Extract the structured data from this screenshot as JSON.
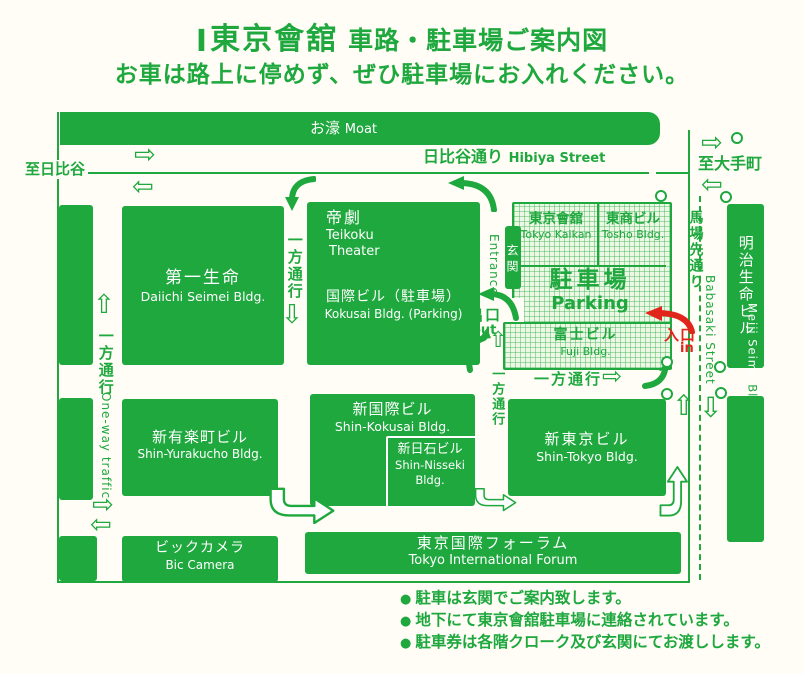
{
  "colors": {
    "green": "#1ea83e",
    "red": "#e1251b",
    "paper": "#fffdf6",
    "hatch_fill": "#ecf7e4"
  },
  "glyphs": {
    "logo": "Ⅰ",
    "bullet": "●",
    "arrow_right": "⇨",
    "arrow_left": "⇦",
    "arrow_up": "⇧",
    "arrow_down": "⇩"
  },
  "title": {
    "main": "東京會舘",
    "suffix": "車路・駐車場ご案内図",
    "subtitle": "お車は路上に停めず、ぜひ駐車場にお入れください。"
  },
  "map": {
    "moat_jp": "お濠",
    "moat_en": "Moat",
    "hibiya_jp": "日比谷通り",
    "hibiya_en": "Hibiya Street",
    "to_hibiya": "至日比谷",
    "to_otemachi": "至大手町",
    "babasaki_jp": "馬場先通り",
    "babasaki_en": "Babasaki Street",
    "one_way_jp": "一方通行",
    "one_way_en": "One-way traffic",
    "entrance_jp": "玄関",
    "entrance_en": "Entrance",
    "exit_jp": "出口",
    "exit_en": "out",
    "in_jp": "入口",
    "in_en": "in",
    "buildings": {
      "daiichi_jp": "第一生命",
      "daiichi_en": "Daiichi Seimei Bldg.",
      "teikoku_jp": "帝劇",
      "teikoku_en1": "Teikoku",
      "teikoku_en2": "Theater",
      "kokusai_jp": "国際ビル（駐車場）",
      "kokusai_en": "Kokusai Bldg. (Parking)",
      "kaikan_jp": "東京會舘",
      "kaikan_en": "Tokyo Kaikan",
      "tosho_jp": "東商ビル",
      "tosho_en": "Tosho Bldg.",
      "parking_jp": "駐車場",
      "parking_en": "Parking",
      "fuji_jp": "富士ビル",
      "fuji_en": "Fuji Bldg.",
      "shin_yurakucho_jp": "新有楽町ビル",
      "shin_yurakucho_en": "Shin-Yurakucho Bldg.",
      "shin_kokusai_jp": "新国際ビル",
      "shin_kokusai_en": "Shin-Kokusai Bldg.",
      "shin_nisseki_jp": "新日石ビル",
      "shin_nisseki_en1": "Shin-Nisseki",
      "shin_nisseki_en2": "Bldg.",
      "shin_tokyo_jp": "新東京ビル",
      "shin_tokyo_en": "Shin-Tokyo Bldg.",
      "bic_jp": "ビックカメラ",
      "bic_en": "Bic Camera",
      "forum_jp": "東京国際フォーラム",
      "forum_en": "Tokyo International Forum",
      "meiji_jp": "明治生命ビル",
      "meiji_en1": "Meiji Seimei",
      "meiji_en2": "Bldg."
    }
  },
  "notes": [
    "駐車は玄関でご案内致します。",
    "地下にて東京會舘駐車場に連絡されています。",
    "駐車券は各階クローク及び玄関にてお渡しします。"
  ]
}
